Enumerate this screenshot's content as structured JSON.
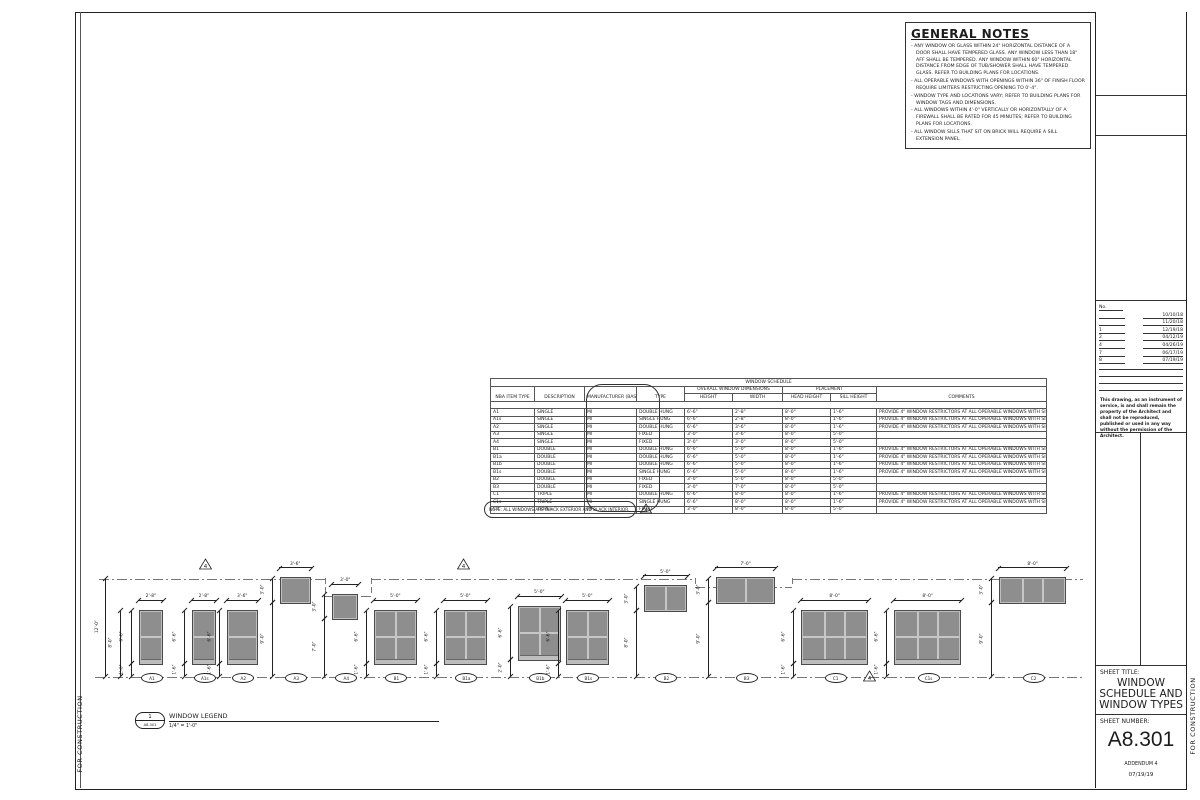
{
  "sheet": {
    "general_notes": {
      "title": "GENERAL NOTES",
      "items": [
        "ANY WINDOW OR GLASS WITHIN 24\" HORIZONTAL DISTANCE OF A DOOR SHALL HAVE TEMPERED GLASS. ANY WINDOW LESS THAN 18\" AFF SHALL BE TEMPERED. ANY WINDOW WITHIN 60\" HORIZONTAL DISTANCE FROM EDGE OF TUB/SHOWER SHALL HAVE TEMPERED GLASS. REFER TO BUILDING PLANS FOR LOCATIONS.",
        "ALL OPERABLE WINDOWS WITH OPENINGS WITHIN 36\" OF FINISH FLOOR REQUIRE LIMITERS RESTRICTING OPENING TO 0'-4\".",
        "WINDOW TYPE AND LOCATIONS VARY; REFER TO BUILDING PLANS FOR WINDOW TAGS AND DIMENSIONS.",
        "ALL WINDOWS WITHIN 4'-0\" VERTICALLY OR HORIZONTALLY OF A FIREWALL SHALL BE RATED FOR 45 MINUTES; REFER TO BUILDING PLANS FOR LOCATIONS.",
        "ALL WINDOW SILLS THAT SIT ON BRICK WILL REQUIRE A SILL EXTENSION PANEL."
      ]
    },
    "schedule": {
      "title": "WINDOW SCHEDULE",
      "group_dimensions": "OVERALL WINDOW DIMENSIONS",
      "group_placement": "PLACEMENT",
      "columns": [
        "NBA ITEM TYPE",
        "DESCRIPTION",
        "MANUFACTURER (BASIS OF DESIGN)",
        "TYPE",
        "HEIGHT",
        "WIDTH",
        "HEAD HEIGHT",
        "SILL HEIGHT",
        "COMMENTS"
      ],
      "restrictor_comment": "PROVIDE 4\" WINDOW RESTRICTORS AT ALL OPERABLE WINDOWS WITH SILLS BELOW 36\" A.F.F.",
      "rows": [
        [
          "A1",
          "SINGLE",
          "MI",
          "DOUBLE HUNG",
          "6'-6\"",
          "2'-8\"",
          "8'-0\"",
          "1'-6\"",
          "PROVIDE 4\" WINDOW RESTRICTORS AT ALL OPERABLE WINDOWS WITH SILLS BELOW 36\" A.F.F."
        ],
        [
          "A1s",
          "SINGLE",
          "MI",
          "SINGLE HUNG",
          "6'-6\"",
          "2'-8\"",
          "8'-0\"",
          "1'-6\"",
          "PROVIDE 4\" WINDOW RESTRICTORS AT ALL OPERABLE WINDOWS WITH SILLS BELOW 36\" A.F.F."
        ],
        [
          "A2",
          "SINGLE",
          "MI",
          "DOUBLE HUNG",
          "6'-6\"",
          "3'-6\"",
          "8'-0\"",
          "1'-6\"",
          "PROVIDE 4\" WINDOW RESTRICTORS AT ALL OPERABLE WINDOWS WITH SILLS BELOW 36\" A.F.F."
        ],
        [
          "A3",
          "SINGLE",
          "MI",
          "FIXED",
          "3'-0\"",
          "3'-6\"",
          "8'-0\"",
          "5'-0\"",
          ""
        ],
        [
          "A4",
          "SINGLE",
          "MI",
          "FIXED",
          "3'-0\"",
          "3'-0\"",
          "8'-0\"",
          "5'-0\"",
          ""
        ],
        [
          "B1",
          "DOUBLE",
          "MI",
          "DOUBLE HUNG",
          "6'-6\"",
          "5'-0\"",
          "8'-0\"",
          "1'-6\"",
          "PROVIDE 4\" WINDOW RESTRICTORS AT ALL OPERABLE WINDOWS WITH SILLS BELOW 36\" A.F.F."
        ],
        [
          "B1a",
          "DOUBLE",
          "MI",
          "DOUBLE HUNG",
          "6'-6\"",
          "5'-0\"",
          "8'-0\"",
          "1'-6\"",
          "PROVIDE 4\" WINDOW RESTRICTORS AT ALL OPERABLE WINDOWS WITH SILLS BELOW 36\" A.F.F."
        ],
        [
          "B1b",
          "DOUBLE",
          "MI",
          "DOUBLE HUNG",
          "6'-6\"",
          "5'-0\"",
          "8'-0\"",
          "1'-6\"",
          "PROVIDE 4\" WINDOW RESTRICTORS AT ALL OPERABLE WINDOWS WITH SILLS BELOW 36\" A.F.F."
        ],
        [
          "B1s",
          "DOUBLE",
          "MI",
          "SINGLE HUNG",
          "6'-6\"",
          "5'-0\"",
          "8'-0\"",
          "1'-6\"",
          "PROVIDE 4\" WINDOW RESTRICTORS AT ALL OPERABLE WINDOWS WITH SILLS BELOW 36\" A.F.F."
        ],
        [
          "B2",
          "DOUBLE",
          "MI",
          "FIXED",
          "3'-0\"",
          "5'-0\"",
          "8'-0\"",
          "5'-0\"",
          ""
        ],
        [
          "B3",
          "DOUBLE",
          "MI",
          "FIXED",
          "3'-0\"",
          "7'-0\"",
          "8'-0\"",
          "5'-0\"",
          ""
        ],
        [
          "C1",
          "TRIPLE",
          "MI",
          "DOUBLE HUNG",
          "6'-6\"",
          "8'-0\"",
          "8'-0\"",
          "1'-6\"",
          "PROVIDE 4\" WINDOW RESTRICTORS AT ALL OPERABLE WINDOWS WITH SILLS BELOW 36\" A.F.F."
        ],
        [
          "C1s",
          "TRIPLE",
          "MI",
          "SINGLE HUNG",
          "6'-6\"",
          "8'-0\"",
          "8'-0\"",
          "1'-6\"",
          "PROVIDE 4\" WINDOW RESTRICTORS AT ALL OPERABLE WINDOWS WITH SILLS BELOW 36\" A.F.F."
        ],
        [
          "C2",
          "TRIPLE",
          "MI",
          "FIXED",
          "3'-0\"",
          "8'-0\"",
          "8'-0\"",
          "5'-0\"",
          ""
        ]
      ],
      "note": "NOTE: ALL WINDOWS ARE BLACK EXTERIOR AND BLACK INTERIOR.",
      "revision_triangle": "4"
    },
    "elevation": {
      "overall_dim": {
        "label": "12'-0\"",
        "a": 0,
        "b": 12,
        "x": 10
      },
      "head_lines": [
        {
          "x1": 4,
          "x2": 230,
          "ft": 12
        },
        {
          "x1": 230,
          "x2": 276,
          "ft": 10
        },
        {
          "x1": 276,
          "x2": 600,
          "ft": 12
        },
        {
          "x1": 600,
          "x2": 697,
          "ft": 11
        },
        {
          "x1": 697,
          "x2": 988,
          "ft": 12
        }
      ],
      "triangles": [
        {
          "x": 104,
          "ft": 13.1,
          "label": "4"
        },
        {
          "x": 362,
          "ft": 13.1,
          "label": "4"
        },
        {
          "x": 768,
          "ft": -0.6,
          "label": "4"
        }
      ],
      "stations": [
        {
          "tag": "A1",
          "x": 45,
          "w_ft": 2.67,
          "top_ft": 8,
          "h_ft": 6.5,
          "units": 1,
          "hung": true,
          "width_label": "2'-8\"",
          "dims": [
            {
              "label": "8'-0\"",
              "a": 0,
              "b": 8,
              "off": -20
            },
            {
              "label": "6'-6\"",
              "a": 1.5,
              "b": 8,
              "off": -9
            },
            {
              "label": "1'-6\"",
              "a": 0,
              "b": 1.5,
              "off": -9
            }
          ]
        },
        {
          "tag": "A1s",
          "x": 98,
          "w_ft": 2.67,
          "top_ft": 8,
          "h_ft": 6.5,
          "units": 1,
          "hung": true,
          "width_label": "2'-8\"",
          "dims": [
            {
              "label": "6'-6\"",
              "a": 1.5,
              "b": 8,
              "off": -9
            },
            {
              "label": "1'-6\"",
              "a": 0,
              "b": 1.5,
              "off": -9
            }
          ]
        },
        {
          "tag": "A2",
          "x": 133,
          "w_ft": 3.5,
          "top_ft": 8,
          "h_ft": 6.5,
          "units": 1,
          "hung": true,
          "width_label": "3'-6\"",
          "dims": [
            {
              "label": "6'-6\"",
              "a": 1.5,
              "b": 8,
              "off": -9
            },
            {
              "label": "1'-6\"",
              "a": 0,
              "b": 1.5,
              "off": -9
            }
          ]
        },
        {
          "tag": "A3",
          "x": 186,
          "w_ft": 3.5,
          "top_ft": 12,
          "h_ft": 3,
          "units": 1,
          "hung": false,
          "width_label": "3'-6\"",
          "dims": [
            {
              "label": "3'-0\"",
              "a": 9,
              "b": 12,
              "off": -9
            },
            {
              "label": "9'-0\"",
              "a": 0,
              "b": 9,
              "off": -9
            }
          ]
        },
        {
          "tag": "A4",
          "x": 238,
          "w_ft": 3,
          "top_ft": 10,
          "h_ft": 3,
          "units": 1,
          "hung": false,
          "width_label": "3'-0\"",
          "dims": [
            {
              "label": "3'-0\"",
              "a": 7,
              "b": 10,
              "off": -9
            },
            {
              "label": "7'-0\"",
              "a": 0,
              "b": 7,
              "off": -9
            }
          ]
        },
        {
          "tag": "B1",
          "x": 280,
          "w_ft": 5,
          "top_ft": 8,
          "h_ft": 6.5,
          "units": 2,
          "hung": true,
          "width_label": "5'-0\"",
          "dims": [
            {
              "label": "6'-6\"",
              "a": 1.5,
              "b": 8,
              "off": -9
            },
            {
              "label": "1'-6\"",
              "a": 0,
              "b": 1.5,
              "off": -9
            }
          ]
        },
        {
          "tag": "B1a",
          "x": 350,
          "w_ft": 5,
          "top_ft": 8,
          "h_ft": 6.5,
          "units": 2,
          "hung": true,
          "width_label": "5'-0\"",
          "dims": [
            {
              "label": "6'-6\"",
              "a": 1.5,
              "b": 8,
              "off": -9
            },
            {
              "label": "1'-6\"",
              "a": 0,
              "b": 1.5,
              "off": -9
            }
          ]
        },
        {
          "tag": "B1b",
          "x": 424,
          "w_ft": 5,
          "top_ft": 8.5,
          "h_ft": 6.5,
          "units": 2,
          "hung": true,
          "width_label": "5'-0\"",
          "dims": [
            {
              "label": "6'-6\"",
              "a": 2,
              "b": 8.5,
              "off": -9
            },
            {
              "label": "2'-0\"",
              "a": 0,
              "b": 2,
              "off": -9
            }
          ]
        },
        {
          "tag": "B1s",
          "x": 472,
          "w_ft": 5,
          "top_ft": 8,
          "h_ft": 6.5,
          "units": 2,
          "hung": true,
          "width_label": "5'-0\"",
          "dims": [
            {
              "label": "6'-6\"",
              "a": 1.5,
              "b": 8,
              "off": -9
            },
            {
              "label": "1'-6\"",
              "a": 0,
              "b": 1.5,
              "off": -9
            }
          ]
        },
        {
          "tag": "B2",
          "x": 550,
          "w_ft": 5,
          "top_ft": 11,
          "h_ft": 3,
          "units": 2,
          "hung": false,
          "width_label": "5'-0\"",
          "dims": [
            {
              "label": "3'-0\"",
              "a": 8,
              "b": 11,
              "off": -9
            },
            {
              "label": "8'-0\"",
              "a": 0,
              "b": 8,
              "off": -9
            }
          ]
        },
        {
          "tag": "B3",
          "x": 622,
          "w_ft": 7,
          "top_ft": 12,
          "h_ft": 3,
          "units": 2,
          "hung": false,
          "width_label": "7'-0\"",
          "dims": [
            {
              "label": "3'-0\"",
              "a": 9,
              "b": 12,
              "off": -9
            },
            {
              "label": "9'-0\"",
              "a": 0,
              "b": 9,
              "off": -9
            }
          ]
        },
        {
          "tag": "C1",
          "x": 707,
          "w_ft": 8,
          "top_ft": 8,
          "h_ft": 6.5,
          "units": 3,
          "hung": true,
          "width_label": "8'-0\"",
          "dims": [
            {
              "label": "6'-6\"",
              "a": 1.5,
              "b": 8,
              "off": -9
            },
            {
              "label": "1'-6\"",
              "a": 0,
              "b": 1.5,
              "off": -9
            }
          ]
        },
        {
          "tag": "C1s",
          "x": 800,
          "w_ft": 8,
          "top_ft": 8,
          "h_ft": 6.5,
          "units": 3,
          "hung": true,
          "width_label": "8'-0\"",
          "dims": [
            {
              "label": "6'-6\"",
              "a": 1.5,
              "b": 8,
              "off": -9
            },
            {
              "label": "1'-6\"",
              "a": 0,
              "b": 1.5,
              "off": -9
            }
          ]
        },
        {
          "tag": "C2",
          "x": 905,
          "w_ft": 8,
          "top_ft": 12,
          "h_ft": 3,
          "units": 3,
          "hung": false,
          "width_label": "8'-0\"",
          "dims": [
            {
              "label": "3'-0\"",
              "a": 9,
              "b": 12,
              "off": -9
            },
            {
              "label": "9'-0\"",
              "a": 0,
              "b": 9,
              "off": -9
            }
          ]
        }
      ]
    },
    "legend": {
      "detail_number": "1",
      "sheet_ref": "A8.301",
      "title": "WINDOW LEGEND",
      "scale": "1/4\" = 1'-0\""
    },
    "title_block": {
      "revisions": {
        "header": "No.",
        "rows": [
          {
            "no": "",
            "date": "10/10/18"
          },
          {
            "no": "",
            "date": "11/20/18"
          },
          {
            "no": "1",
            "date": "12/19/18"
          },
          {
            "no": "2",
            "date": "04/12/19"
          },
          {
            "no": "4",
            "date": "04/26/19"
          },
          {
            "no": "7",
            "date": "06/17/19"
          },
          {
            "no": "8",
            "date": "07/19/19"
          }
        ]
      },
      "disclaimer": "This drawing, as an instrument of service, is and shall remain the property of the Architect and shall not be reproduced, published or used in any way without the permission of the Architect.",
      "sheet_title_label": "SHEET TITLE:",
      "sheet_title": "WINDOW SCHEDULE AND WINDOW TYPES",
      "sheet_number_label": "SHEET NUMBER:",
      "sheet_number": "A8.301",
      "addendum": "ADDENDUM 4",
      "date": "07/19/19",
      "stamp": "FOR CONSTRUCTION"
    }
  }
}
